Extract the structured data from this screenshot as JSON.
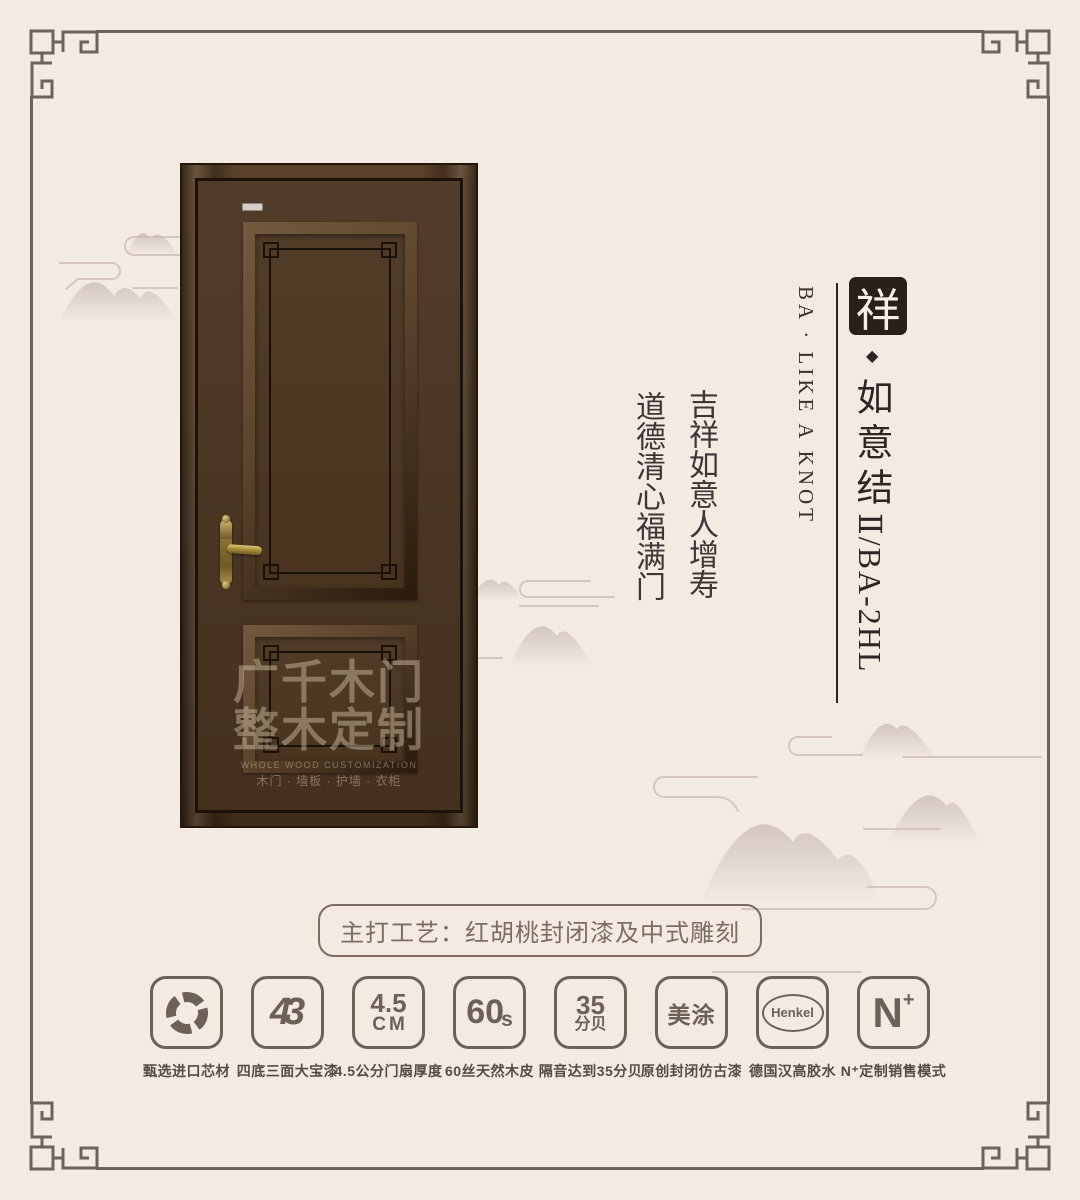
{
  "colors": {
    "background": "#f3eae2",
    "frame_border": "#6e625e",
    "title_ink": "#2d2523",
    "couplet_ink": "#3d3536",
    "craft_accent": "#7d6c62",
    "feature_accent": "#6d6057",
    "seal_bg": "#29201b",
    "seal_text": "#f6f0e7",
    "door_wood": "#4a3523",
    "handle_brass": "#a98f44"
  },
  "title": {
    "seal": "祥",
    "diamond": "◆",
    "name_cjk": "如意结",
    "name_code": "Ⅱ/BA-2HL",
    "subtitle": "BA · LIKE A KNOT"
  },
  "couplet": {
    "line_right": "吉祥如意人增寿",
    "line_left": "道德清心福满门"
  },
  "craft_label": "主打工艺：红胡桃封闭漆及中式雕刻",
  "door_watermark": {
    "line1": "广千木门",
    "line2": "整木定制",
    "line3": "WHOLE WOOD CUSTOMIZATION",
    "line4": "木门 · 墙板 · 护墙 · 衣柜"
  },
  "features": [
    {
      "label": "甄选进口芯材"
    },
    {
      "glyph": "43",
      "label": "四底三面大宝漆"
    },
    {
      "glyph_top": "4.5",
      "glyph_bottom": "CM",
      "label": "4.5公分门扇厚度"
    },
    {
      "glyph": "60",
      "glyph_sub": "s",
      "label": "60丝天然木皮"
    },
    {
      "glyph_top": "35",
      "glyph_bottom": "分贝",
      "label": "隔音达到35分贝"
    },
    {
      "glyph": "美涂",
      "label": "原创封闭仿古漆"
    },
    {
      "glyph": "Henkel",
      "label": "德国汉高胶水"
    },
    {
      "glyph": "N",
      "glyph_sup": "+",
      "label": "N⁺定制销售模式"
    }
  ]
}
